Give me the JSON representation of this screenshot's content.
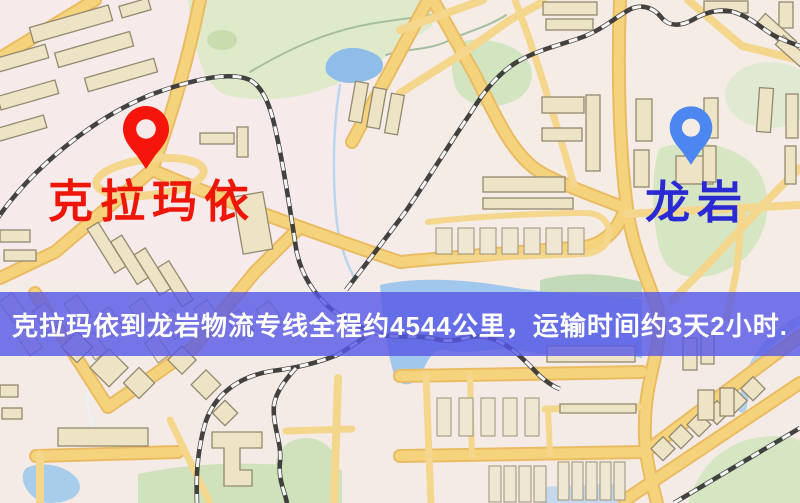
{
  "map": {
    "kind": "street-map",
    "palette": {
      "background": "#f5ece8",
      "road": "#f5d37d",
      "road_edge": "#e9bc63",
      "railway": "#333333",
      "water": "#9cc5ec",
      "park": "#d6e6c3",
      "building": "#ede3c5"
    }
  },
  "markers": {
    "origin": {
      "icon": "map-pin-icon",
      "label": "克拉玛依",
      "pin_color": "#f6150a",
      "label_color": "#ee1509"
    },
    "destination": {
      "icon": "map-pin-icon",
      "label": "龙岩",
      "pin_color": "#4c86f0",
      "label_color": "#2a2ad4"
    }
  },
  "banner": {
    "text": "克拉玛依到龙岩物流专线全程约4544公里，运输时间约3天2小时.",
    "background": "#5658e6",
    "text_color": "#ffffff"
  },
  "route": {
    "origin": "克拉玛依",
    "destination": "龙岩",
    "distance_text": "约4544公里",
    "duration_text": "约3天2小时"
  }
}
